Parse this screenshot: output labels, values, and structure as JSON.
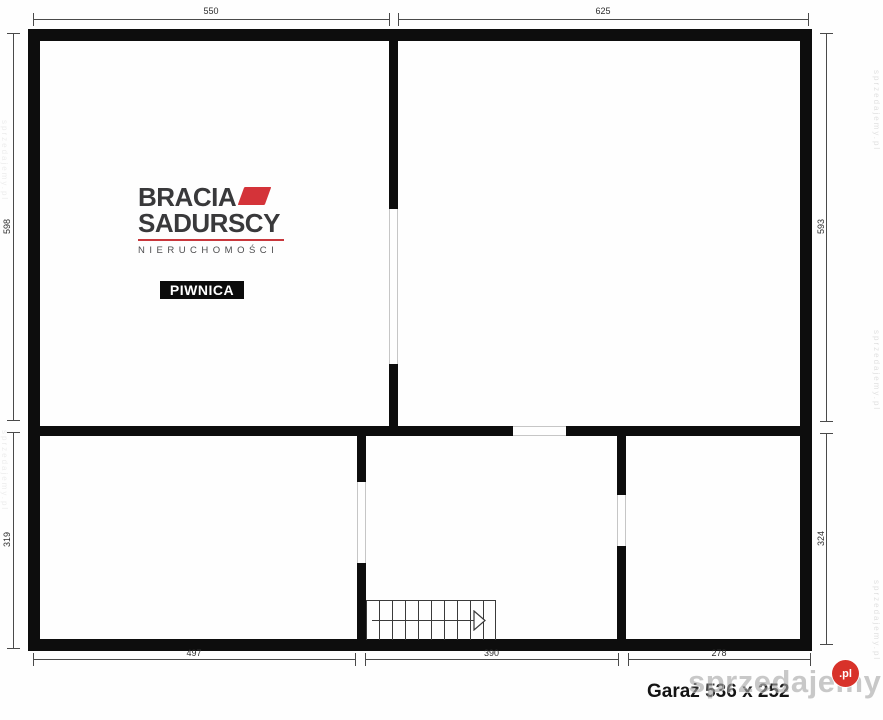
{
  "branding": {
    "name_line1": "BRACIA",
    "name_line2": "SADURSCY",
    "tagline": "NIERUCHOMOŚCI",
    "brand_red": "#d43339",
    "brand_dark": "#39393b"
  },
  "plan": {
    "room_label": "PIWNICA",
    "garage_note": "Garaż 536 x 252",
    "dims": {
      "top_left": "550",
      "top_right": "625",
      "left_upper": "598",
      "left_lower": "319",
      "right_upper": "593",
      "right_lower": "324",
      "bottom_left": "497",
      "bottom_middle": "390",
      "bottom_right": "278"
    }
  },
  "watermark": {
    "text": "sprzedajemy",
    "tld": ".pl",
    "red": "#d8322a",
    "side_text": "sprzedajemy.pl"
  }
}
